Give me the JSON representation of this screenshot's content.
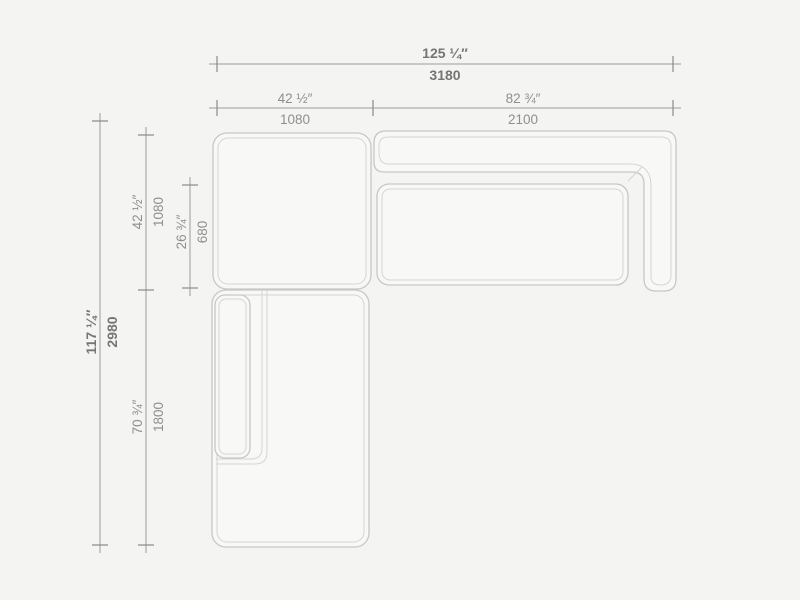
{
  "drawing": {
    "subject": "sectional-sofa-top-view-dimension-drawing",
    "colors": {
      "background": "#f4f4f3",
      "piece_fill": "#f8f8f7",
      "piece_outline": "#c7c7c5",
      "piece_inner_line": "#d5d5d3",
      "dimension_line": "#9b9b9b",
      "dimension_text": "#8f8f8f",
      "total_dimension_text": "#757575"
    },
    "horizontal": {
      "total": {
        "inches": "125 ¼″",
        "mm": "3180"
      },
      "left": {
        "inches": "42 ½″",
        "mm": "1080"
      },
      "right": {
        "inches": "82 ¾″",
        "mm": "2100"
      }
    },
    "vertical": {
      "total": {
        "inches": "117 ¼″",
        "mm": "2980"
      },
      "corner": {
        "inches": "42 ½″",
        "mm": "1080"
      },
      "seat": {
        "inches": "26 ¾″",
        "mm": "680"
      },
      "chaise": {
        "inches": "70 ¾″",
        "mm": "1800"
      }
    }
  }
}
